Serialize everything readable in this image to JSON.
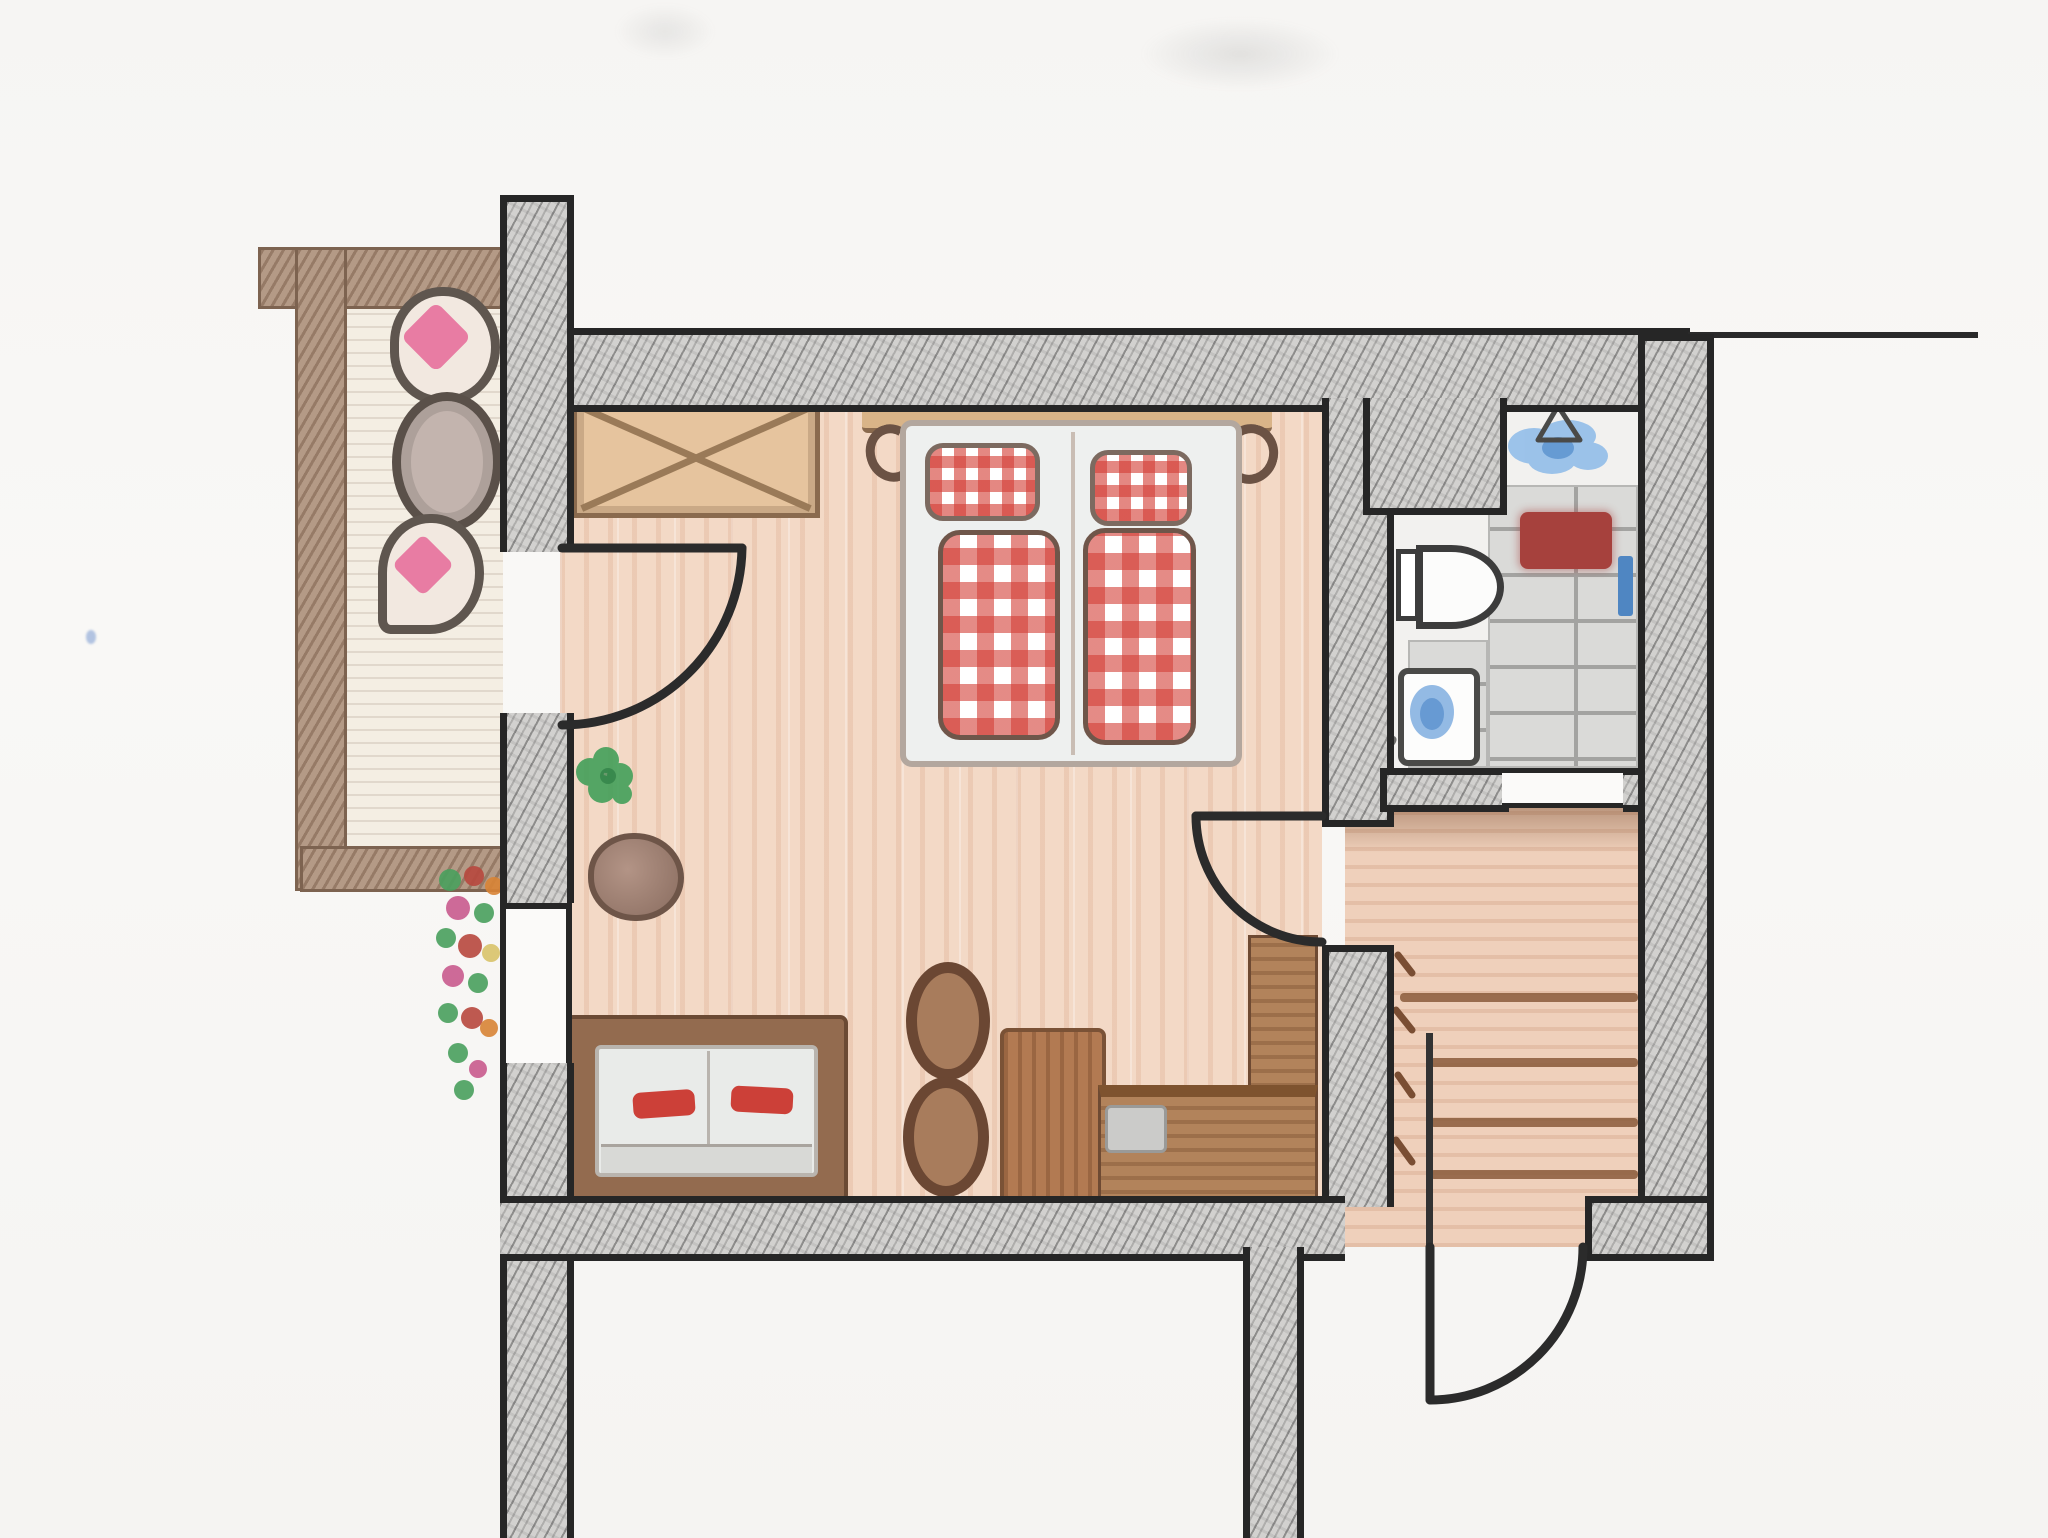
{
  "document": {
    "type": "hand-drawn floor plan sketch, pencil and colored pencil on white paper, top-down view",
    "visible_text": "none"
  },
  "palette": {
    "outline_black": "#262626",
    "wall_hatch_gray": "#d2d1cf",
    "floor_wood_peach": "#f3d9c6",
    "balcony_floor_cream": "#f4eee3",
    "balcony_rail_brown": "#b49a86",
    "furniture_wood_brown": "#b27a52",
    "bed_linen_white": "#eef0ef",
    "gingham_red": "#d33e36",
    "cushion_pink": "#e87ca3",
    "plant_green": "#3f9e57",
    "water_blue": "#6fa3dc",
    "bath_mat_red": "#a6413d",
    "tile_gray": "#dadad8",
    "towel_orange": "#d89a50",
    "towel_blue": "#4f86c2"
  },
  "structure": {
    "walls_label": "hatched masonry wall",
    "wall_line_label": "thin wall line continuing right"
  },
  "rooms": {
    "bedroom": {
      "label": "bedroom and sitting room with wooden floor"
    },
    "bathroom": {
      "label": "bathroom with stone tile floor"
    },
    "stair_hall": {
      "label": "stair hall with wooden floor"
    },
    "balcony": {
      "label": "balcony with plank floor"
    }
  },
  "openings": {
    "balcony_door": {
      "label": "balcony door swinging into bedroom"
    },
    "hall_door": {
      "label": "door from bedroom to stair hall"
    },
    "entrance_door": {
      "label": "entrance door at bottom swinging outward"
    },
    "bathroom_door": {
      "label": "bathroom door opening"
    },
    "window": {
      "label": "window in left wall"
    }
  },
  "furniture": {
    "wardrobe": {
      "label": "wardrobe drawn with crossed diagonals"
    },
    "bed": {
      "label": "double bed with wooden headboard",
      "pillows": 2,
      "duvets": 2,
      "pillow_label": "red-white gingham pillow",
      "duvet_label": "red-white gingham duvet"
    },
    "sofa": {
      "label": "sofa with light cushions",
      "cushion_label": "small red cushion",
      "red_cushions": 2
    },
    "table": {
      "label": "long wooden table"
    },
    "chairs": {
      "label": "round wooden chair",
      "count": 2
    },
    "corner_bench": {
      "label": "L-shaped corner bench",
      "cushion_label": "gray seat cushion"
    },
    "plant": {
      "label": "green plant on bedroom floor"
    },
    "rock": {
      "label": "round stone decoration"
    },
    "balcony_seat_top": {
      "label": "balcony seat with pink cushion"
    },
    "balcony_table": {
      "label": "round balcony table"
    },
    "balcony_seat_bottom": {
      "label": "balcony seat with pink cushion"
    },
    "flower_garland": {
      "label": "flower box with green, red, pink and orange flowers"
    }
  },
  "bathroom_items": {
    "tiles": {
      "label": "gray stone shower tiles"
    },
    "shower": {
      "label": "shower area with blue water and triangle symbol"
    },
    "toilet": {
      "label": "toilet with tank against wall"
    },
    "sink": {
      "label": "sink with blue water"
    },
    "bath_mat": {
      "label": "dark red bath mat"
    },
    "towel_orange": {
      "label": "orange towel on wall"
    },
    "towel_blue": {
      "label": "blue towel on right wall"
    },
    "plant": {
      "label": "small green bathroom plant"
    },
    "slippers": {
      "label": "pair of gray slippers"
    }
  },
  "stairs": {
    "label": "staircase going down to entrance",
    "steps": 4,
    "step_label": "stair step edge"
  }
}
